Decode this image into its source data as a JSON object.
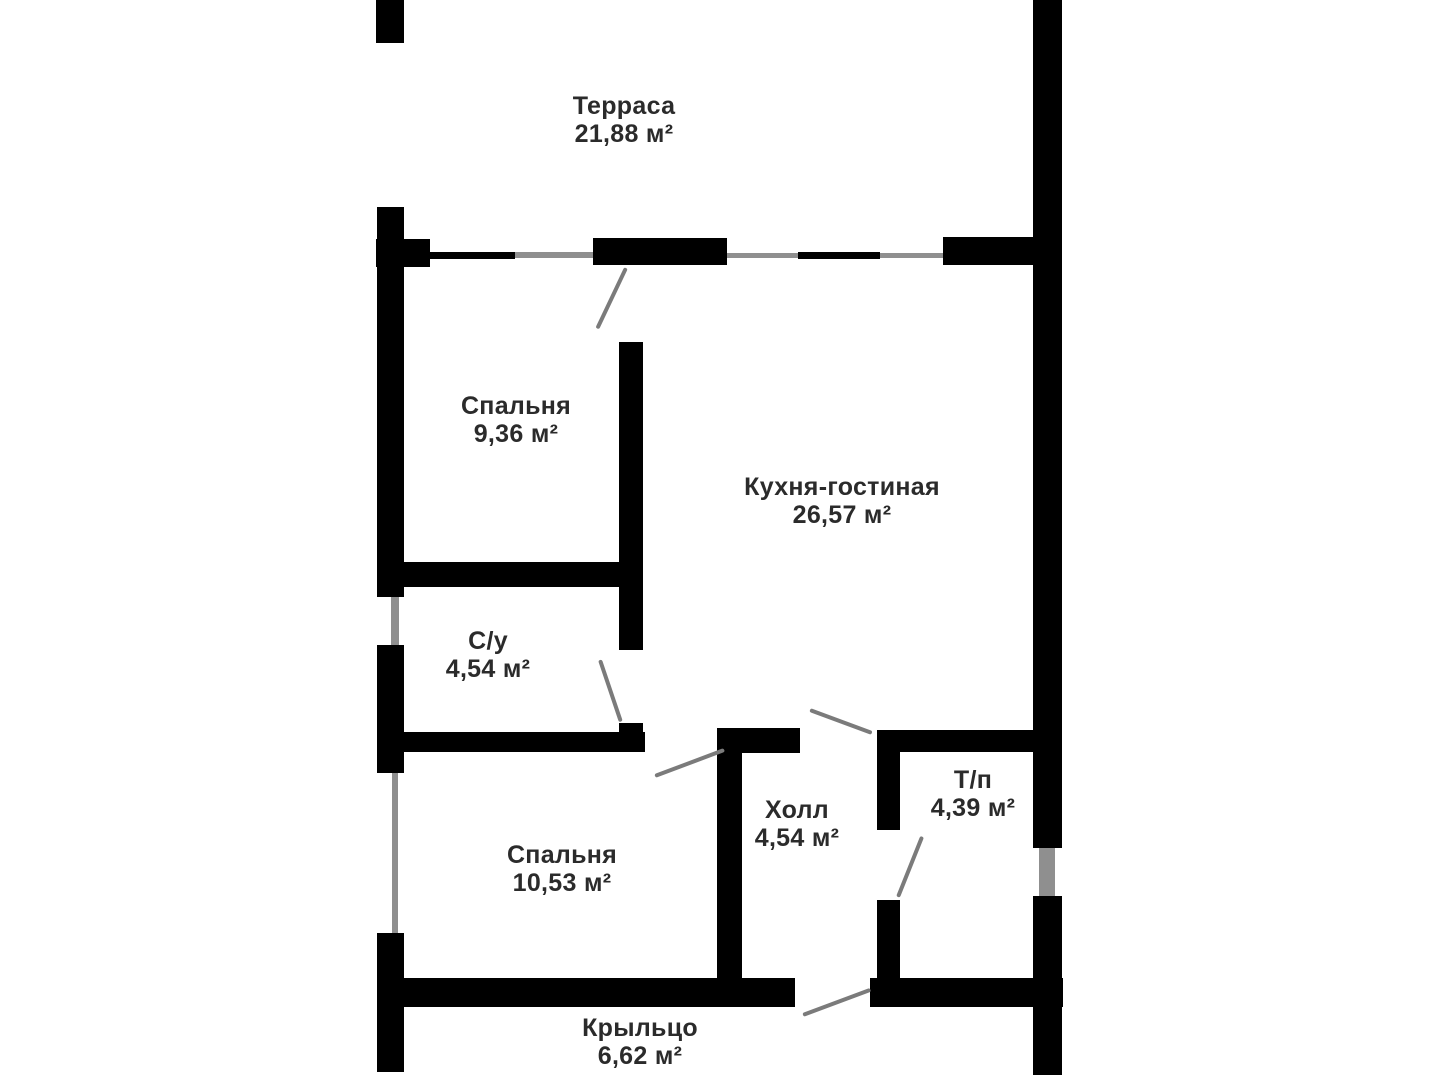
{
  "plan": {
    "rooms": [
      {
        "id": "terrace",
        "name": "Терраса",
        "area": "21,88 м²"
      },
      {
        "id": "bedroom1",
        "name": "Спальня",
        "area": "9,36 м²"
      },
      {
        "id": "kitchen",
        "name": "Кухня-гостиная",
        "area": "26,57 м²"
      },
      {
        "id": "bathroom",
        "name": "С/у",
        "area": "4,54 м²"
      },
      {
        "id": "bedroom2",
        "name": "Спальня",
        "area": "10,53 м²"
      },
      {
        "id": "hall",
        "name": "Холл",
        "area": "4,54 м²"
      },
      {
        "id": "tp",
        "name": "Т/п",
        "area": "4,39 м²"
      },
      {
        "id": "porch",
        "name": "Крыльцо",
        "area": "6,62 м²"
      }
    ],
    "colors": {
      "wall": "#000000",
      "window": "#8f8f8f",
      "door": "#7b7b7b",
      "text": "#2b2b2b",
      "background": "#ffffff"
    }
  }
}
